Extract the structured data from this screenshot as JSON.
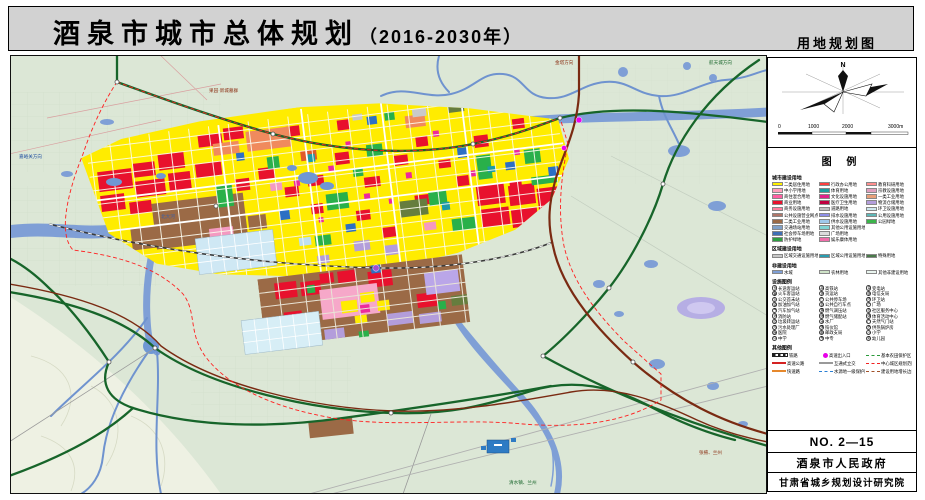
{
  "header": {
    "title": "酒泉市城市总体规划",
    "years": "（2016-2030年）",
    "map_type": "用地规划图"
  },
  "panel": {
    "north_label": "N",
    "scale_ticks": [
      "0",
      "1000",
      "2000",
      "3000m"
    ],
    "legend_title": "图 例",
    "sections": {
      "urban": "城市建设用地",
      "regional": "区域建设用地",
      "nonconstruction": "非建设用地",
      "facilities": "设施图例",
      "lines": "其他图例"
    },
    "landuse": [
      {
        "label": "二类居住用地",
        "color": "#fff100"
      },
      {
        "label": "中小学用地",
        "color": "#ff9ebb"
      },
      {
        "label": "商住混合用地",
        "color": "#ff5fa2"
      },
      {
        "label": "商业用地",
        "color": "#e8112d"
      },
      {
        "label": "商务设施用地",
        "color": "#ff7f9e"
      },
      {
        "label": "公共设施营业网点用地",
        "color": "#b0766a"
      },
      {
        "label": "二类工业用地",
        "color": "#9b6a46"
      },
      {
        "label": "交通场站用地",
        "color": "#7fa0c8"
      },
      {
        "label": "社会停车场用地",
        "color": "#3f6fb5"
      },
      {
        "label": "防护绿地",
        "color": "#2e9e41"
      },
      {
        "label": "行政办公用地",
        "color": "#ff4040"
      },
      {
        "label": "体育用地",
        "color": "#1d9e9e"
      },
      {
        "label": "文化设施用地",
        "color": "#e0218a"
      },
      {
        "label": "医疗卫生用地",
        "color": "#c00040"
      },
      {
        "label": "道路用地",
        "color": "#c0c0c0"
      },
      {
        "label": "排水设施用地",
        "color": "#8f8fe8"
      },
      {
        "label": "供水设施用地",
        "color": "#9fc9eb"
      },
      {
        "label": "其他公用设施用地",
        "color": "#7fd4d4"
      },
      {
        "label": "广场用地",
        "color": "#dcdcdc"
      },
      {
        "label": "娱乐康体用地",
        "color": "#f06eaa"
      },
      {
        "label": "教育科研用地",
        "color": "#ff8f8f"
      },
      {
        "label": "宗教设施用地",
        "color": "#e0a0c0"
      },
      {
        "label": "一类工业用地",
        "color": "#e8a07a"
      },
      {
        "label": "物流仓储用地",
        "color": "#b39ddb"
      },
      {
        "label": "环卫设施用地",
        "color": "#cfe8ef"
      },
      {
        "label": "公用设施用地",
        "color": "#5fb8b8"
      },
      {
        "label": "公园绿地",
        "color": "#3cb44b"
      }
    ],
    "regional": [
      {
        "label": "区域交通设施用地",
        "color": "#c8c8c8"
      },
      {
        "label": "区域公用设施用地",
        "color": "#2a9db0"
      },
      {
        "label": "特殊用地",
        "color": "#4a7a4a"
      }
    ],
    "nonconstruction": [
      {
        "label": "水域",
        "color": "#7f9fd6"
      },
      {
        "label": "农林用地",
        "color": "#cfe3c8"
      },
      {
        "label": "其他非建设用地",
        "color": "#e9f5ef"
      }
    ],
    "facilities": [
      {
        "sym": "长",
        "label": "长途客运站"
      },
      {
        "sym": "客",
        "label": "火车客运站"
      },
      {
        "sym": "公",
        "label": "公交首末站"
      },
      {
        "sym": "油",
        "label": "加油加气站"
      },
      {
        "sym": "气",
        "label": "汽车加气站"
      },
      {
        "sym": "消",
        "label": "消防站"
      },
      {
        "sym": "垃",
        "label": "垃圾转运站"
      },
      {
        "sym": "污",
        "label": "污水处理厂"
      },
      {
        "sym": "医",
        "label": "医院"
      },
      {
        "sym": "中",
        "label": "中学"
      },
      {
        "sym": "高",
        "label": "高铁站"
      },
      {
        "sym": "货",
        "label": "货运站"
      },
      {
        "sym": "P",
        "label": "公共停车场"
      },
      {
        "sym": "自",
        "label": "公共自行车点"
      },
      {
        "sym": "调",
        "label": "燃气调压站"
      },
      {
        "sym": "储",
        "label": "燃气储配站"
      },
      {
        "sym": "水",
        "label": "水厂"
      },
      {
        "sym": "殡",
        "label": "殡仪馆"
      },
      {
        "sym": "邮",
        "label": "邮政支局"
      },
      {
        "sym": "专",
        "label": "中专"
      },
      {
        "sym": "变",
        "label": "变电站"
      },
      {
        "sym": "信",
        "label": "电信支局"
      },
      {
        "sym": "环",
        "label": "环卫站"
      },
      {
        "sym": "广",
        "label": "广场"
      },
      {
        "sym": "社",
        "label": "社区服务中心"
      },
      {
        "sym": "体",
        "label": "体育活动中心"
      },
      {
        "sym": "门",
        "label": "天然气门站"
      },
      {
        "sym": "热",
        "label": "供热锅炉房"
      },
      {
        "sym": "小",
        "label": "小学"
      },
      {
        "sym": "幼",
        "label": "幼儿园"
      }
    ],
    "lines": [
      {
        "style": "rail",
        "label": "铁路"
      },
      {
        "style": "highway",
        "label": "高速公路"
      },
      {
        "style": "expwy",
        "label": "快速路"
      },
      {
        "style": "node",
        "label": "高速出入口"
      },
      {
        "style": "interchange",
        "label": "互通式立交"
      },
      {
        "style": "watersrc",
        "label": "水源地一级保护区"
      },
      {
        "style": "farm",
        "label": "基本农田保护区"
      },
      {
        "style": "boundary",
        "label": "中心城区规划范围"
      },
      {
        "style": "growth",
        "label": "建设用地增长边界"
      }
    ],
    "doc_no": "NO. 2—15",
    "government": "酒泉市人民政府",
    "institute": "甘肃省城乡规划设计研究院"
  },
  "map": {
    "labels": [
      {
        "text": "嘉峪关方向",
        "x": 8,
        "y": 102,
        "c": "#1f4fa0"
      },
      {
        "text": "果园·新城墓群",
        "x": 198,
        "y": 36,
        "c": "#8b2f13"
      },
      {
        "text": "金塔方向",
        "x": 544,
        "y": 8,
        "c": "#8b2f13"
      },
      {
        "text": "航天城方向",
        "x": 698,
        "y": 8,
        "c": "#17652a"
      },
      {
        "text": "张掖、兰州",
        "x": 688,
        "y": 398,
        "c": "#8b2f13"
      },
      {
        "text": "清水镇、兰州",
        "x": 498,
        "y": 428,
        "c": "#17652a"
      },
      {
        "text": "北大河",
        "x": 150,
        "y": 162,
        "c": "#3a5fa8"
      }
    ]
  }
}
